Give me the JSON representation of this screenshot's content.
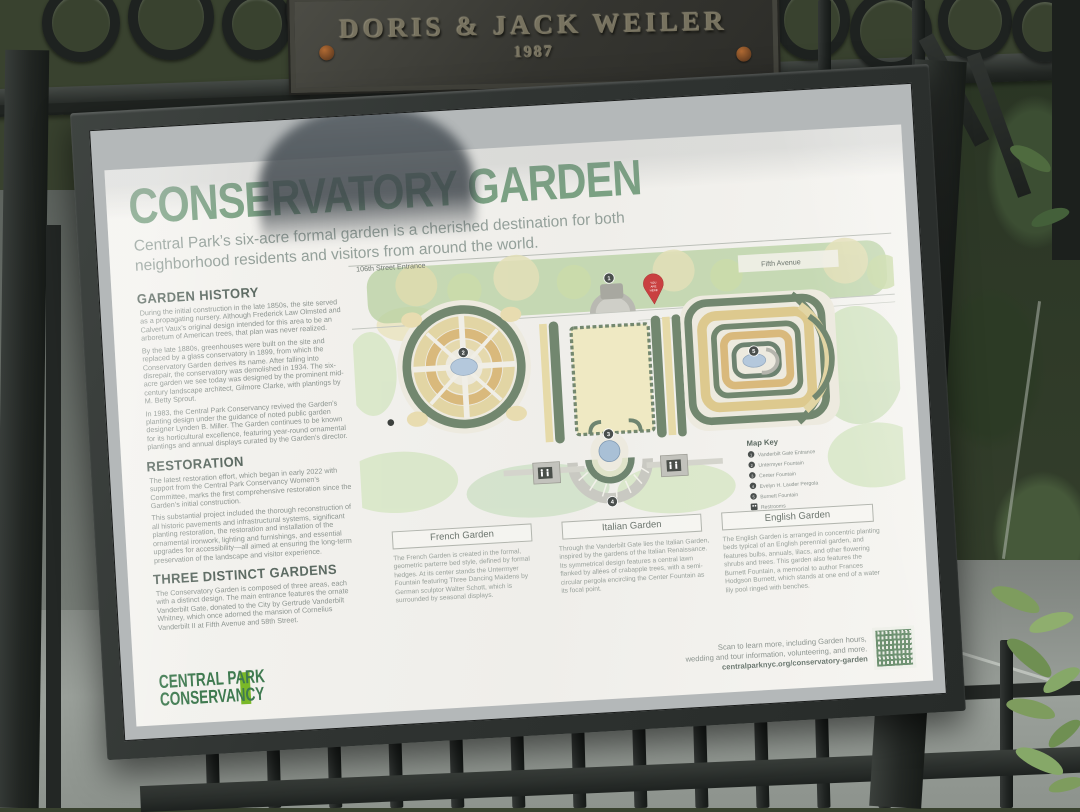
{
  "plaque": {
    "title": "DORIS & JACK WEILER",
    "year": "1987"
  },
  "sign": {
    "title": "CONSERVATORY GARDEN",
    "subtitle": "Central Park’s six-acre formal garden is a cherished destination for both neighborhood residents and visitors from around the world.",
    "sections": [
      {
        "heading": "GARDEN HISTORY",
        "paragraphs": [
          "During the initial construction in the late 1850s, the site served as a propagating nursery. Although Frederick Law Olmsted and Calvert Vaux’s original design intended for this area to be an arboretum of American trees, that plan was never realized.",
          "By the late 1880s, greenhouses were built on the site and replaced by a glass conservatory in 1899, from which the Conservatory Garden derives its name. After falling into disrepair, the conservatory was demolished in 1934. The six-acre garden we see today was designed by the prominent mid-century landscape architect, Gilmore Clarke, with plantings by M. Betty Sprout.",
          "In 1983, the Central Park Conservancy revived the Garden’s planting design under the guidance of noted public garden designer Lynden B. Miller. The Garden continues to be known for its horticultural excellence, featuring year-round ornamental plantings and annual displays curated by the Garden’s director."
        ]
      },
      {
        "heading": "RESTORATION",
        "paragraphs": [
          "The latest restoration effort, which began in early 2022 with support from the Central Park Conservancy Women’s Committee, marks the first comprehensive restoration since the Garden’s initial construction.",
          "This substantial project included the thorough reconstruction of all historic pavements and infrastructural systems, significant planting restoration, the restoration and installation of the ornamental ironwork, lighting and furnishings, and essential upgrades for accessibility—all aimed at ensuring the long-term preservation of the landscape and visitor experience."
        ]
      },
      {
        "heading": "THREE DISTINCT GARDENS",
        "paragraphs": [
          "The Conservatory Garden is composed of three areas, each with a distinct design. The main entrance features the ornate Vanderbilt Gate, donated to the City by Gertrude Vanderbilt Whitney, which once adorned the mansion of Cornelius Vanderbilt II at Fifth Avenue and 58th Street."
        ]
      }
    ],
    "map": {
      "street_label": "106th Street Entrance",
      "avenue_label": "Fifth Avenue",
      "pin_lines": [
        "YOU",
        "ARE",
        "HERE"
      ],
      "key": {
        "title": "Map Key",
        "items": [
          {
            "n": "1",
            "label": "Vanderbilt Gate Entrance"
          },
          {
            "n": "2",
            "label": "Untermyer Fountain"
          },
          {
            "n": "3",
            "label": "Center Fountain"
          },
          {
            "n": "4",
            "label": "Evelyn H. Lauder Pergola"
          },
          {
            "n": "5",
            "label": "Burnett Fountain"
          }
        ],
        "restrooms": "Restrooms"
      },
      "gardens": [
        {
          "label": "French Garden",
          "caption": "The French Garden is created in the formal, geometric parterre bed style, defined by formal hedges. At its center stands the Untermyer Fountain featuring Three Dancing Maidens by German sculptor Walter Schott, which is surrounded by seasonal displays."
        },
        {
          "label": "Italian Garden",
          "caption": "Through the Vanderbilt Gate lies the Italian Garden, inspired by the gardens of the Italian Renaissance. Its symmetrical design features a central lawn flanked by allées of crabapple trees, with a semi-circular pergola encircling the Center Fountain as its focal point."
        },
        {
          "label": "English Garden",
          "caption": "The English Garden is arranged in concentric planting beds typical of an English perennial garden, and features bulbs, annuals, lilacs, and other flowering shrubs and trees. This garden also features the Burnett Fountain, a memorial to author Frances Hodgson Burnett, which stands at one end of a water lily pool ringed with benches."
        }
      ]
    },
    "logo": {
      "line1": "CENTRAL PARK",
      "line2": "CONSERVANCY"
    },
    "footer": {
      "scan_line1": "Scan to learn more, including Garden hours,",
      "scan_line2": "wedding and tour information, volunteering, and more.",
      "url": "centralparknyc.org/conservatory-garden"
    }
  },
  "colors": {
    "title_green": "#7ba183",
    "heading_gray_green": "#5d6b63",
    "body_gray": "#8c948f",
    "logo_green": "#3f7a50",
    "logo_bar_green": "#7ab828",
    "map_hedge": "#72876f",
    "map_bed_tan": "#e2d5a4",
    "map_bed_orange": "#d9b97c",
    "map_water": "#b4c8dc",
    "pin_red": "#c94040",
    "frame_black": "#303432"
  }
}
